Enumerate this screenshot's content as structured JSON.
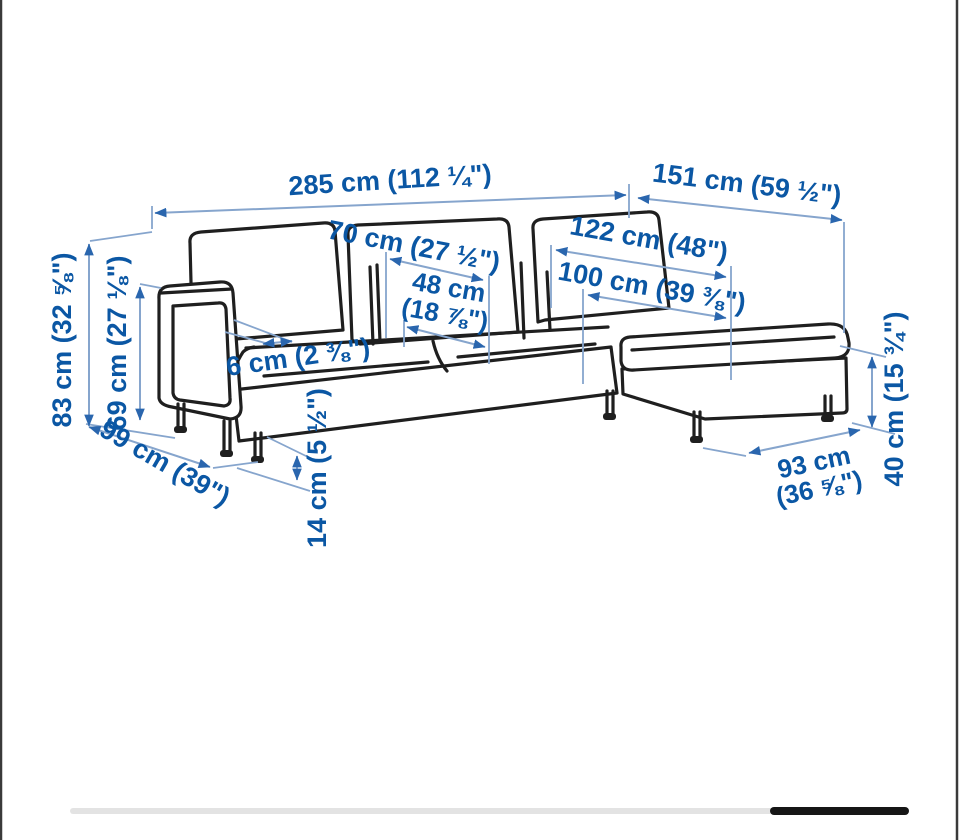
{
  "colors": {
    "text_blue": "#0b57a4",
    "dim_line": "#86a5cd",
    "arrow_blue": "#2a66ae",
    "drawing_line": "#1f1f1f",
    "edge_border": "#3a3a3a",
    "scrollbar_track": "#e3e3e3",
    "scrollbar_thumb": "#161616"
  },
  "diagram": {
    "subject": "sofa-with-chaise-dimension-drawing",
    "dims": {
      "width_overall": {
        "text": "285 cm (112 ¼\")"
      },
      "depth_with_chaise": {
        "text": "151 cm (59 ½\")"
      },
      "back_cushion_width": {
        "text": "70 cm (27 ½\")"
      },
      "chaise_length": {
        "text": "122 cm (48\")"
      },
      "seat_cushion_width": {
        "line1": "48 cm",
        "line2": "(18 ⅞\")"
      },
      "chaise_cushion_length": {
        "text": "100 cm (39 ⅜\")"
      },
      "armrest_thickness": {
        "text": "6 cm (2 ⅜\")"
      },
      "height_total": {
        "text": "83 cm (32 ⅝\")"
      },
      "height_armrest": {
        "text": "69 cm (27 ⅛\")"
      },
      "depth_sofa": {
        "text": "99 cm (39\")"
      },
      "leg_height": {
        "text": "14 cm (5 ½\")"
      },
      "chaise_width": {
        "line1": "93 cm",
        "line2": "(36 ⅝\")"
      },
      "seat_height": {
        "text": "40 cm (15 ¾\")"
      }
    }
  },
  "scrollbar": {
    "visible": true
  }
}
